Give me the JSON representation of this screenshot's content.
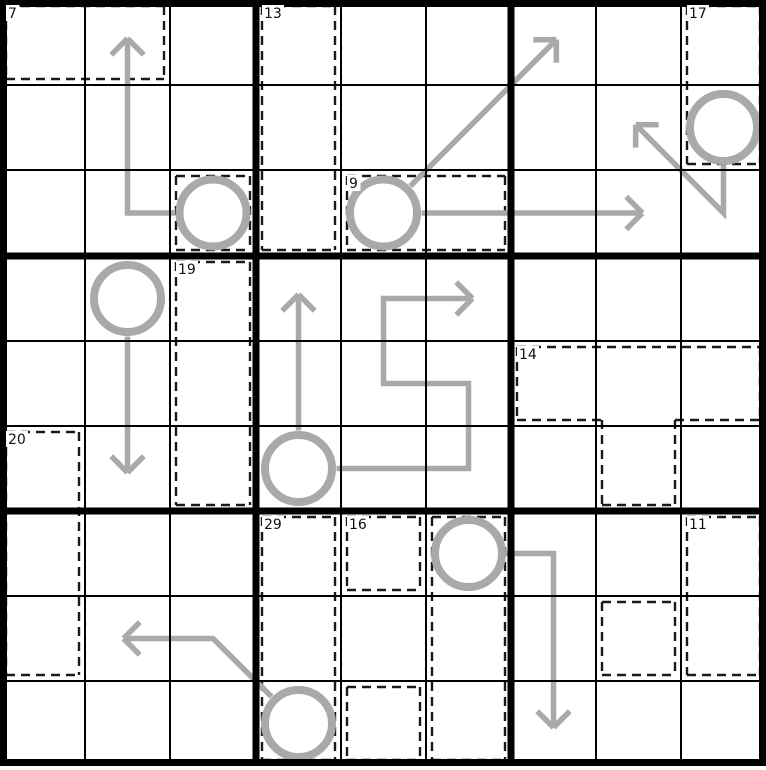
{
  "board": {
    "rows": 9,
    "cols": 9,
    "colors": {
      "background": "#ffffff",
      "grid_line_thin": "#000000",
      "grid_line_thick": "#000000",
      "cage_border": "#1a1a1a",
      "cage_label": "#111111",
      "cage_label_bg": "#ffffff",
      "arrow": "#a9a9a9"
    },
    "cages": [
      {
        "sum": "7",
        "cells": [
          [
            1,
            1
          ],
          [
            1,
            2
          ]
        ]
      },
      {
        "sum": "13",
        "cells": [
          [
            1,
            4
          ],
          [
            2,
            4
          ],
          [
            3,
            4
          ]
        ]
      },
      {
        "sum": "17",
        "cells": [
          [
            1,
            9
          ],
          [
            2,
            9
          ]
        ]
      },
      {
        "sum": null,
        "cells": [
          [
            3,
            3
          ]
        ]
      },
      {
        "sum": "9",
        "cells": [
          [
            3,
            5
          ],
          [
            3,
            6
          ]
        ]
      },
      {
        "sum": "19",
        "cells": [
          [
            4,
            3
          ],
          [
            5,
            3
          ],
          [
            6,
            3
          ]
        ]
      },
      {
        "sum": "14",
        "cells": [
          [
            5,
            7
          ],
          [
            5,
            8
          ],
          [
            5,
            9
          ],
          [
            6,
            8
          ]
        ]
      },
      {
        "sum": "20",
        "cells": [
          [
            6,
            1
          ],
          [
            7,
            1
          ],
          [
            8,
            1
          ]
        ]
      },
      {
        "sum": "29",
        "cells": [
          [
            7,
            4
          ],
          [
            8,
            4
          ],
          [
            9,
            4
          ]
        ]
      },
      {
        "sum": "16",
        "cells": [
          [
            7,
            5
          ]
        ]
      },
      {
        "sum": null,
        "cells": [
          [
            7,
            6
          ],
          [
            8,
            6
          ],
          [
            9,
            6
          ]
        ]
      },
      {
        "sum": null,
        "cells": [
          [
            9,
            5
          ]
        ]
      },
      {
        "sum": "11",
        "cells": [
          [
            7,
            9
          ],
          [
            8,
            9
          ]
        ]
      },
      {
        "sum": null,
        "cells": [
          [
            8,
            8
          ]
        ]
      }
    ],
    "arrows": [
      {
        "circle": [
          3,
          3
        ],
        "waypoints": [
          [
            3,
            2
          ],
          [
            1,
            2
          ]
        ]
      },
      {
        "circle": [
          3,
          5
        ],
        "waypoints": [
          [
            1,
            7
          ]
        ]
      },
      {
        "circle": [
          3,
          5
        ],
        "waypoints": [
          [
            3,
            8
          ]
        ]
      },
      {
        "circle": [
          2,
          9
        ],
        "waypoints": [
          [
            3,
            9
          ],
          [
            2,
            8
          ]
        ]
      },
      {
        "circle": [
          4,
          2
        ],
        "waypoints": [
          [
            6,
            2
          ]
        ]
      },
      {
        "circle": [
          6,
          4
        ],
        "waypoints": [
          [
            4,
            4
          ]
        ]
      },
      {
        "circle": [
          6,
          4
        ],
        "waypoints": [
          [
            6,
            6
          ],
          [
            5,
            6
          ],
          [
            5,
            5
          ],
          [
            4,
            5
          ],
          [
            4,
            6
          ]
        ]
      },
      {
        "circle": [
          7,
          6
        ],
        "waypoints": [
          [
            7,
            7
          ],
          [
            9,
            7
          ]
        ]
      },
      {
        "circle": [
          9,
          4
        ],
        "waypoints": [
          [
            8,
            3
          ],
          [
            8,
            2
          ]
        ]
      }
    ]
  }
}
